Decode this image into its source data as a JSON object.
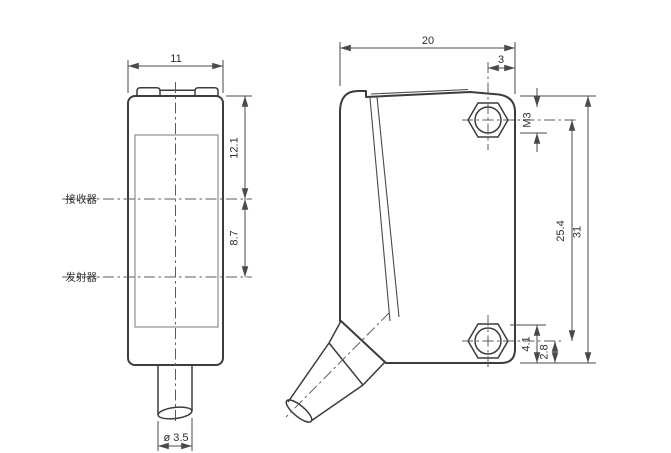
{
  "front_view": {
    "width": "11",
    "receiver_offset": "12.1",
    "emitter_spacing": "8.7",
    "cable_diameter": "ø 3.5",
    "receiver_label": "接收器",
    "emitter_label": "发射器"
  },
  "side_view": {
    "depth": "20",
    "hole_edge_offset": "3",
    "thread": "M3",
    "hole_spacing": "25.4",
    "height": "31",
    "hole_top_offset": "4.1",
    "hole_bottom_offset": "2.8"
  },
  "colors": {
    "body_line": "#3c3c3c",
    "dimension_line": "#4a4a4a",
    "centerline": "#5b5b5b",
    "window_line": "#8f8f8f",
    "text": "#2e2e2e",
    "background": "#ffffff"
  }
}
